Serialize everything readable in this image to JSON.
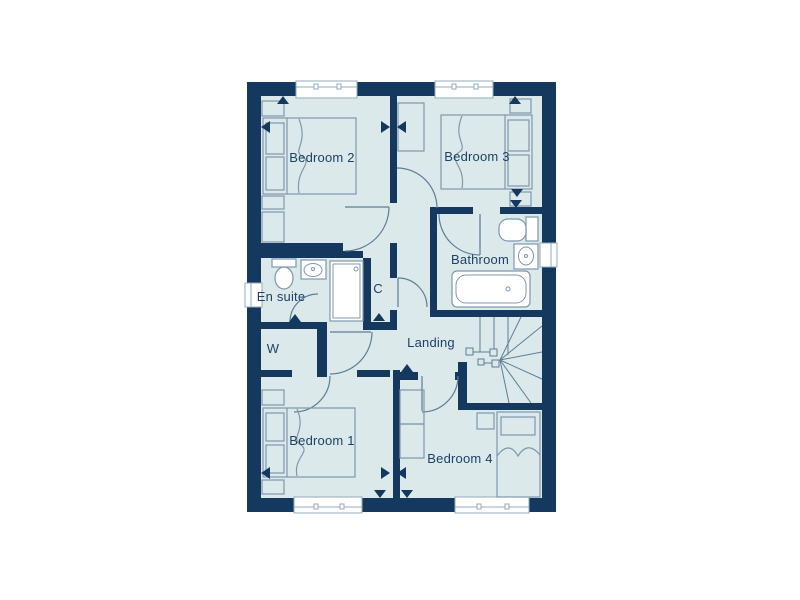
{
  "floorplan": {
    "rooms": [
      {
        "id": "bedroom-2",
        "label": "Bedroom 2"
      },
      {
        "id": "bedroom-3",
        "label": "Bedroom 3"
      },
      {
        "id": "bathroom",
        "label": "Bathroom"
      },
      {
        "id": "en-suite",
        "label": "En suite"
      },
      {
        "id": "cupboard",
        "label": "C"
      },
      {
        "id": "wardrobe",
        "label": "W"
      },
      {
        "id": "landing",
        "label": "Landing"
      },
      {
        "id": "bedroom-1",
        "label": "Bedroom 1"
      },
      {
        "id": "bedroom-4",
        "label": "Bedroom 4"
      }
    ],
    "colors": {
      "wall": "#15395e",
      "floor": "#dbe9ea",
      "line": "#7e98ab",
      "door": "#5d7e96",
      "label": "#1c4166",
      "window_frame": "#93a9bc",
      "background": "#ffffff"
    }
  }
}
